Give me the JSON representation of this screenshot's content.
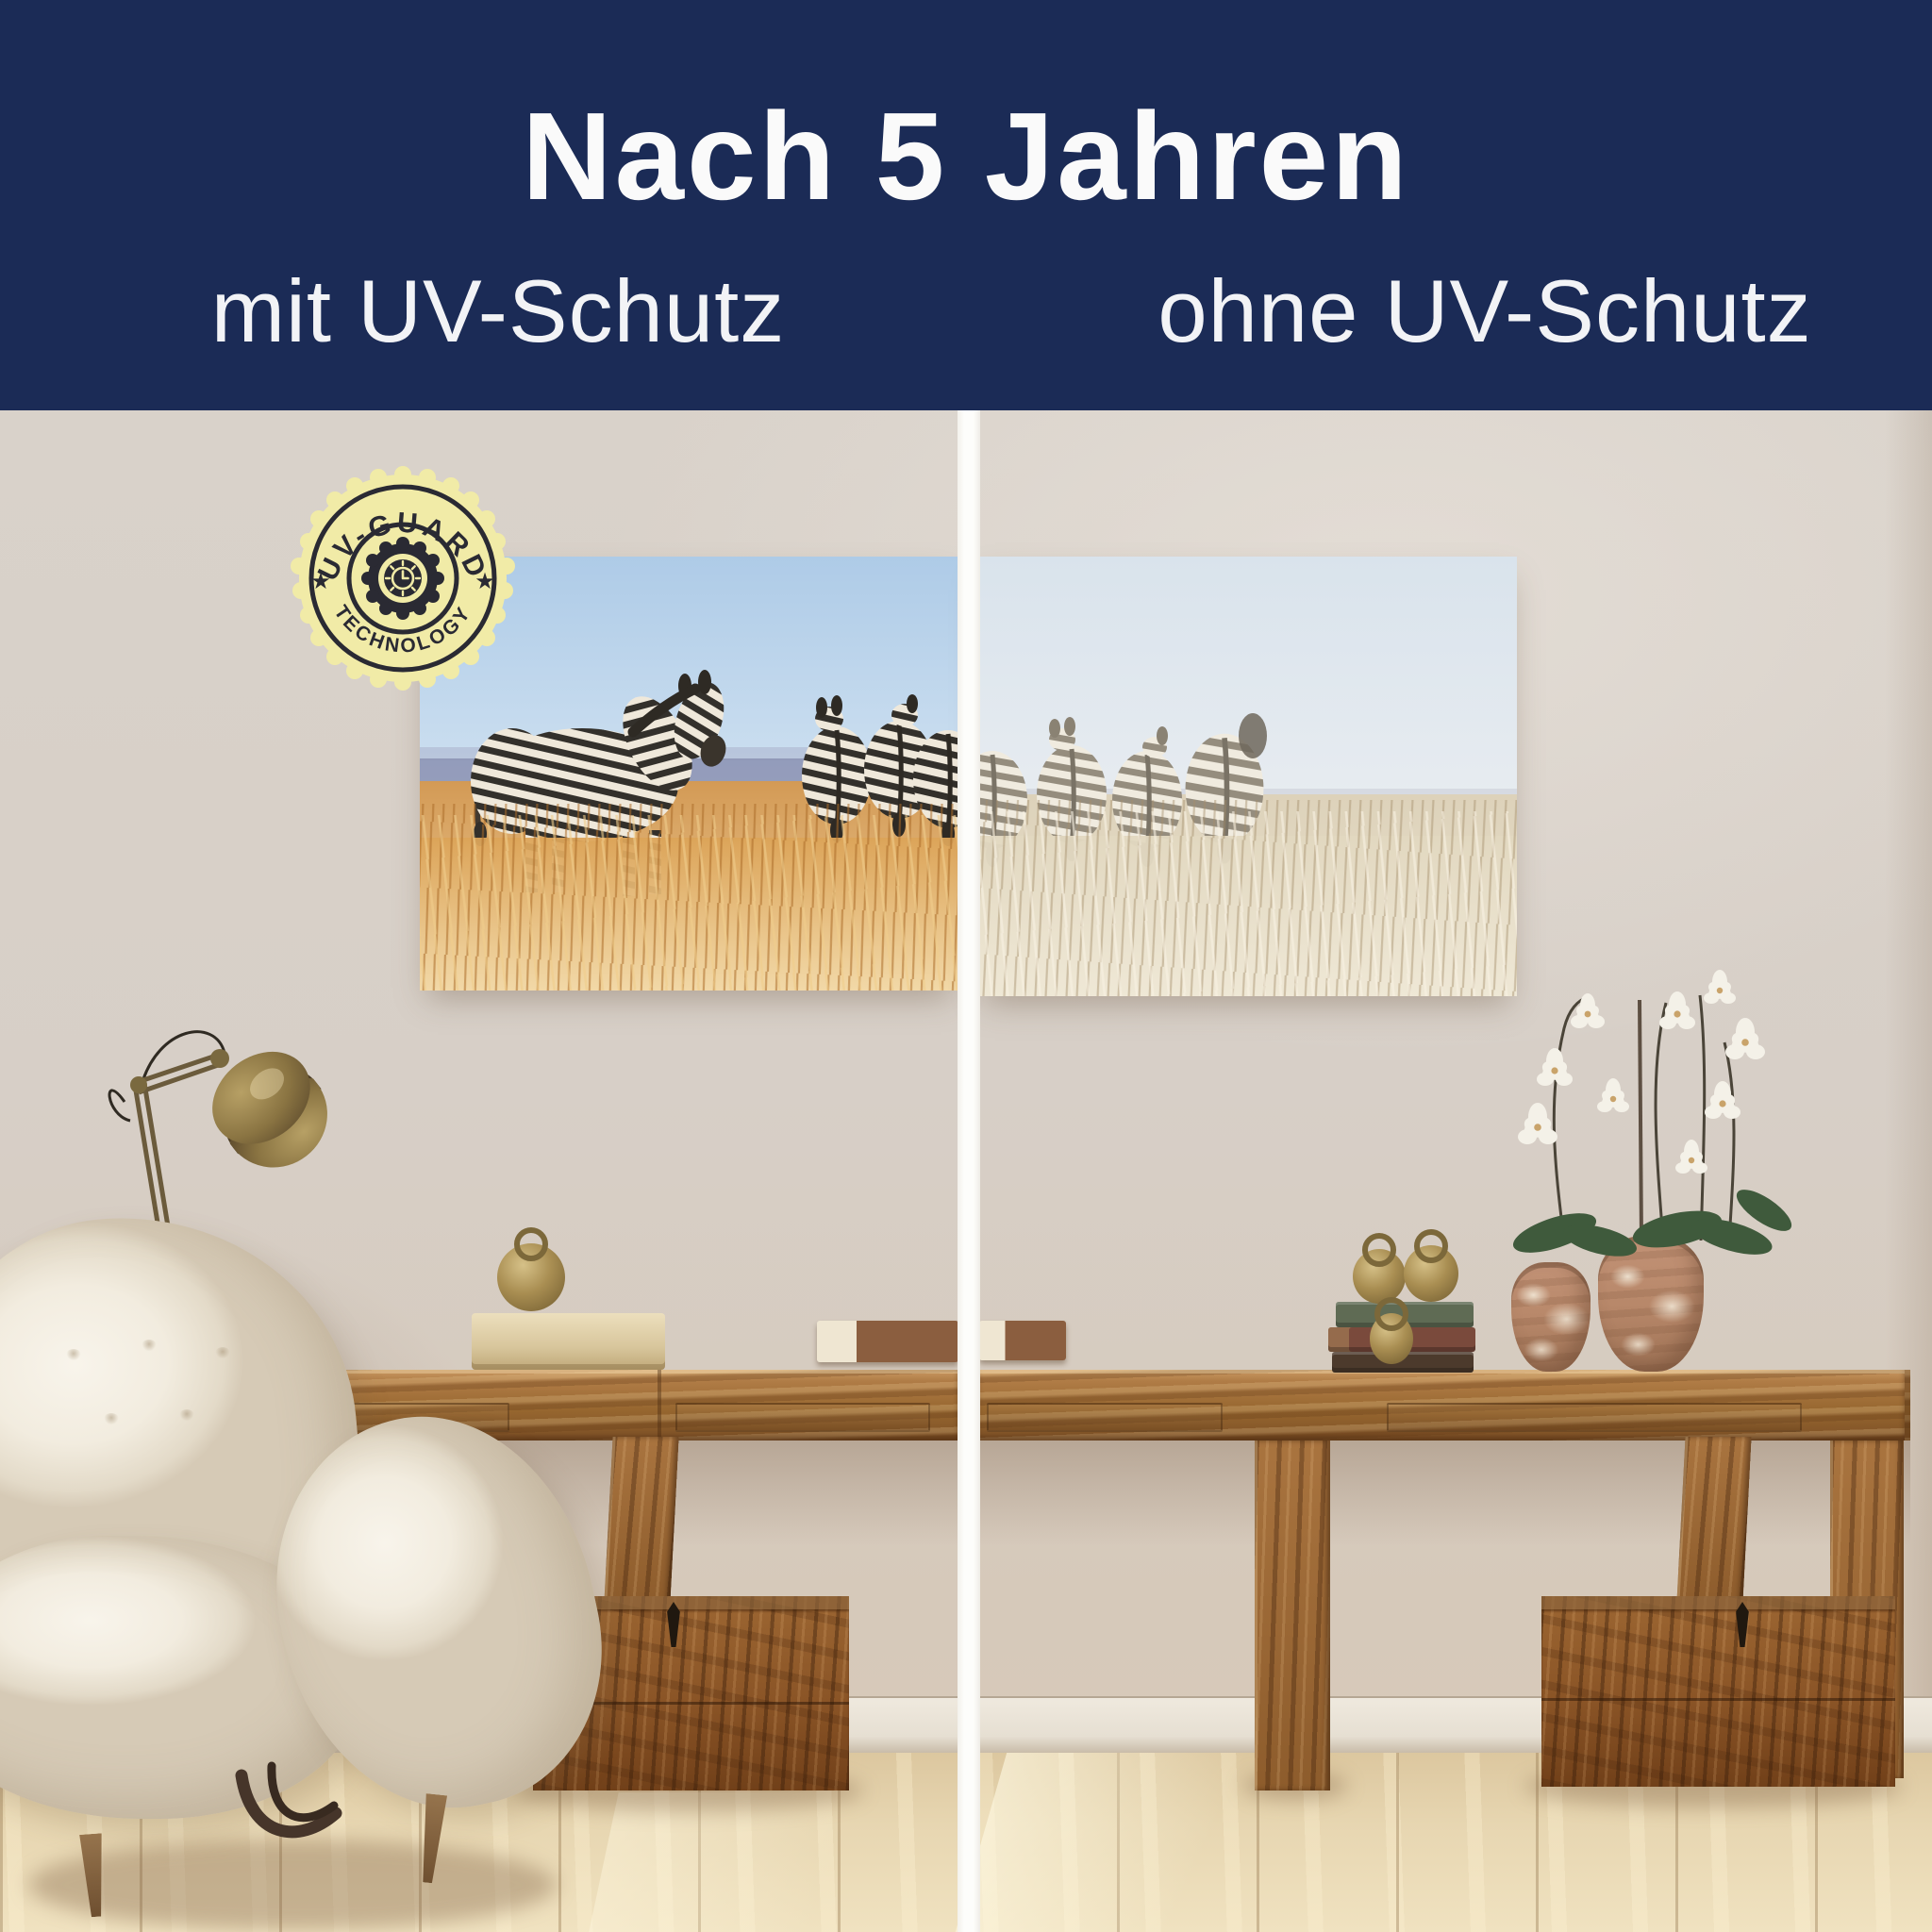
{
  "header": {
    "title": "Nach 5 Jahren",
    "left_label": "mit UV-Schutz",
    "right_label": "ohne UV-Schutz",
    "bg_color": "#1b2b56",
    "text_color": "#fafafa"
  },
  "badge": {
    "top_text": "UV-GUARD",
    "bottom_text": "TECHNOLOGY",
    "star": "★",
    "bg_color": "#f1eba7",
    "ink_color": "#2a2a33"
  },
  "scene": {
    "divider_color": "#fdfdfb",
    "wall_color": "#d7d0c8",
    "floor_color": "#e7d6b1",
    "wood_color": "#a97242",
    "chair_color": "#f2ecdf",
    "brass_color": "#a98e52",
    "canvas_with_uv": {
      "sky_color": "#b6d0e8",
      "ridge_color": "#8a90b2",
      "grass_color": "#dda55f",
      "zebra_dark": "#33302b",
      "zebra_light": "#efe8da"
    },
    "canvas_without_uv": {
      "sky_color": "#dde6ee",
      "grass_color": "#e2d7c0",
      "zebra_dark": "#958d7e",
      "zebra_light": "#f0ebdf"
    }
  }
}
